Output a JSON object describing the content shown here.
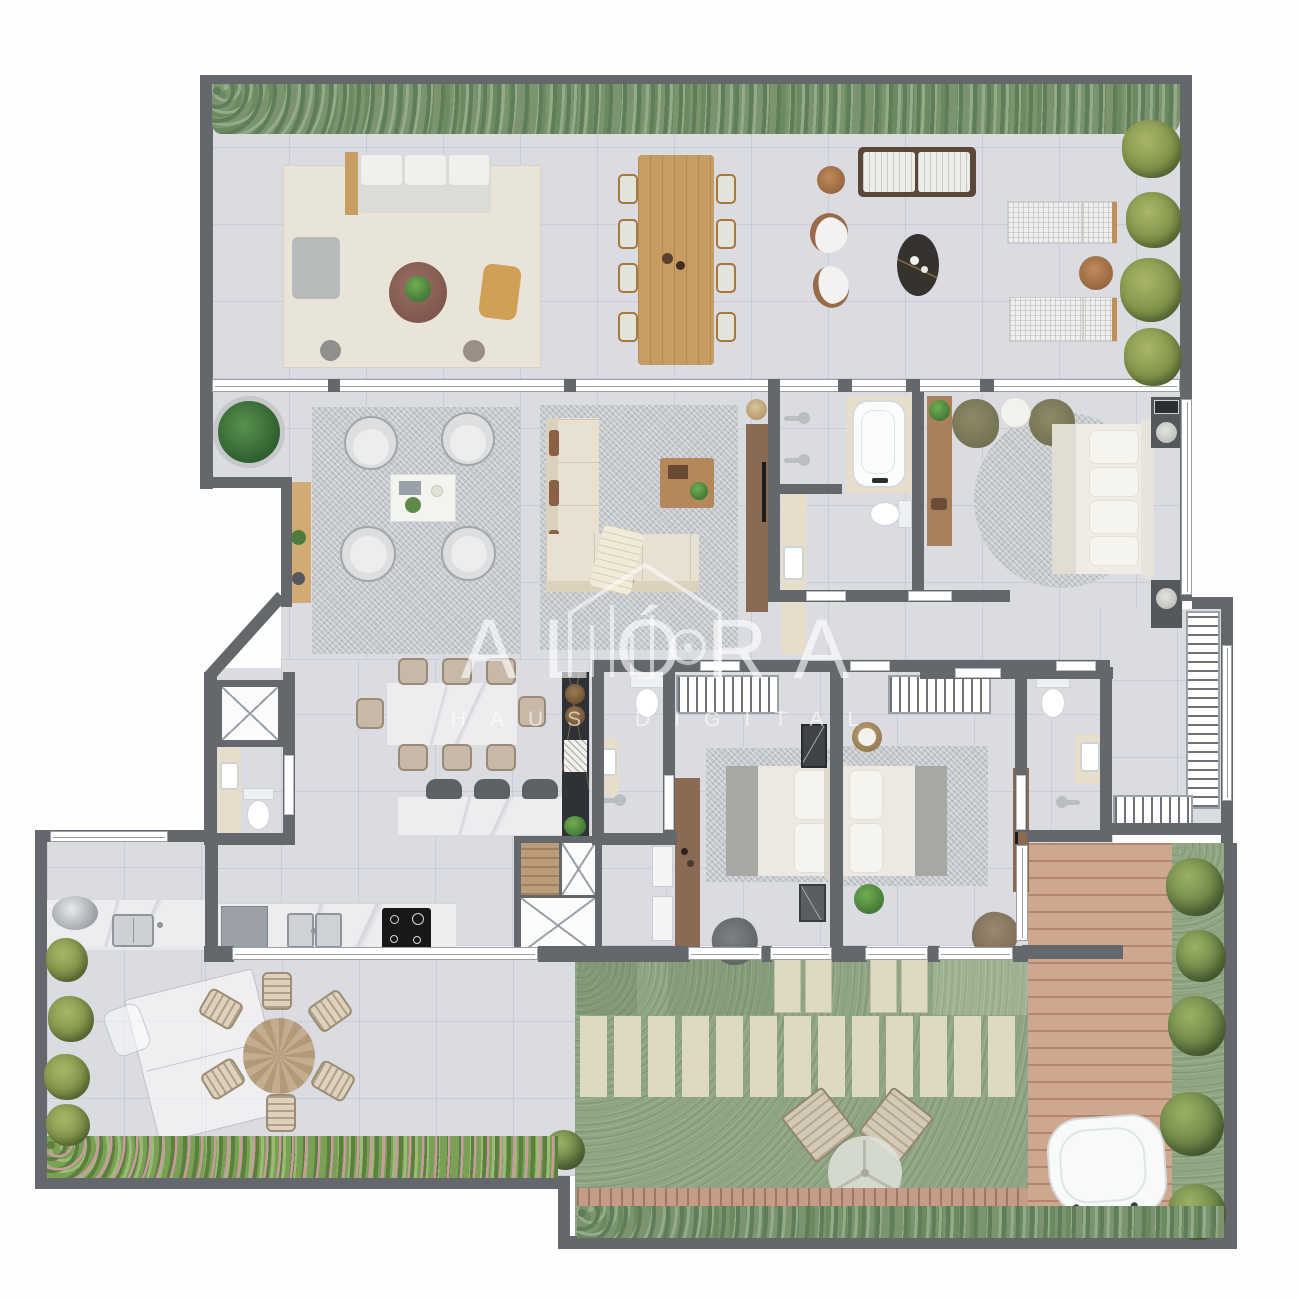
{
  "watermark": {
    "brand": "ALÓRA",
    "subtitle": "HAUS DIGITAL"
  },
  "palette": {
    "wall": "#64676b",
    "floor": "#dbdce2",
    "windowFill": "#ffffff",
    "windowLine": "#9aa0a6",
    "hedge1": "#7c9370",
    "hedge2": "#5f7d58",
    "hedge3": "#93ab88",
    "flower": "#c99aa0",
    "lawn": "#8fa583",
    "paver": "#ded9c3",
    "deck": "#cfa78f",
    "deckLine": "#b28672",
    "boardwalk": "#c59c87",
    "rugBeige": "#e9e4d8",
    "rugGray": "#c6c9cd",
    "marble": "#ededf0",
    "marbleVein": "#d4d5db",
    "travertine": "#e7ddcb",
    "darkStone": "#2e3136",
    "chrome": "#b9bec3",
    "oliveTree": "#6d8748",
    "watermark": "rgba(255,255,255,0.62)"
  },
  "plan": {
    "type": "residential-floor-plan",
    "rooms": [
      {
        "name": "roof-terrace",
        "items": [
          "hedge",
          "outdoor-lounge-rug",
          "outdoor-sofa",
          "pouf",
          "round-coffee-table",
          "stool",
          "outdoor-dining-table-8-chairs",
          "slatted-sofa",
          "curved-armchairs",
          "oval-coffee-table",
          "sun-loungers",
          "side-tables",
          "shrubs"
        ]
      },
      {
        "name": "living-room",
        "items": [
          "large-potted-plant",
          "sideboard",
          "rug-with-4-swivel-chairs",
          "square-coffee-table",
          "sectional-sofa",
          "wood-coffee-table",
          "tv-panel"
        ]
      },
      {
        "name": "master-bathroom",
        "items": [
          "double-shower-heads",
          "bathtub",
          "vanity-sink",
          "toilet"
        ]
      },
      {
        "name": "master-bedroom",
        "items": [
          "wardrobe",
          "two-armchairs",
          "side-table",
          "round-rug",
          "double-bed",
          "nightstands"
        ]
      },
      {
        "name": "walk-in-closet",
        "items": [
          "wardrobe-racks",
          "window"
        ]
      },
      {
        "name": "kitchen-dining",
        "items": [
          "marble-dining-table-8-chairs",
          "island-with-3-stools",
          "dark-stone-cabinet-two-basins",
          "counter-fridge-sink-cooktop",
          "service-shafts"
        ]
      },
      {
        "name": "powder-room",
        "items": [
          "vanity-sink",
          "toilet"
        ]
      },
      {
        "name": "bedroom-2",
        "items": [
          "closet-rack",
          "double-bed",
          "rug",
          "desk",
          "armchair",
          "ensuite-toilet-vanity-shower",
          "dressers",
          "leaning-art"
        ]
      },
      {
        "name": "bedroom-3",
        "items": [
          "closet-rack",
          "double-bed",
          "rug",
          "tv-panel",
          "armchair",
          "ensuite-toilet-vanity-shower",
          "plant-stands"
        ]
      },
      {
        "name": "gourmet-terrace",
        "items": [
          "grill-counter",
          "kettle-grill",
          "sink",
          "ghost-table",
          "round-dining-table-6-chairs",
          "planters",
          "flower-hedge"
        ]
      },
      {
        "name": "garden",
        "items": [
          "lawn",
          "paver-path",
          "stepping-slabs",
          "two-garden-loungers",
          "parasol",
          "boardwalk",
          "hedge",
          "wood-deck",
          "jacuzzi",
          "trees"
        ]
      }
    ]
  }
}
